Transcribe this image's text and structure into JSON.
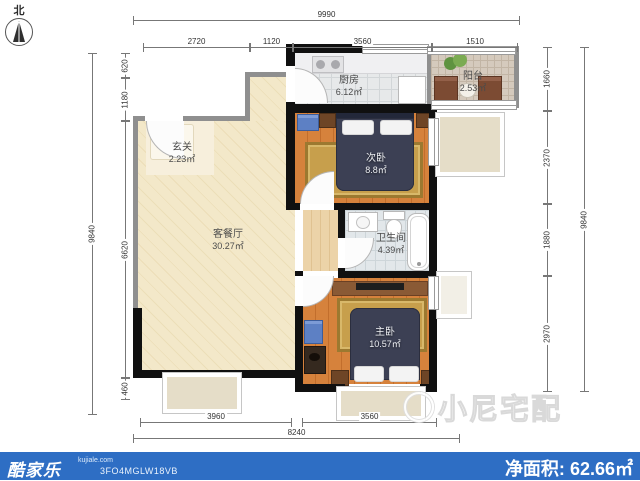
{
  "compass": {
    "north_label": "北"
  },
  "rooms": [
    {
      "id": "entry",
      "name": "玄关",
      "area": "2.23㎡"
    },
    {
      "id": "living",
      "name": "客餐厅",
      "area": "30.27㎡"
    },
    {
      "id": "kitchen",
      "name": "厨房",
      "area": "6.12㎡"
    },
    {
      "id": "balcony",
      "name": "阳台",
      "area": "2.53㎡"
    },
    {
      "id": "bedroom2",
      "name": "次卧",
      "area": "8.8㎡"
    },
    {
      "id": "bathroom",
      "name": "卫生间",
      "area": "4.39㎡"
    },
    {
      "id": "master",
      "name": "主卧",
      "area": "10.57㎡"
    }
  ],
  "dimensions": {
    "top": {
      "overall": "9990",
      "segments": [
        "2720",
        "1120",
        "3560",
        "1510"
      ]
    },
    "bottom": {
      "overall": "8240",
      "segments": [
        "3960",
        "3560"
      ]
    },
    "left": {
      "overall": "9840",
      "segments": [
        "620",
        "1180",
        "6620",
        "460"
      ]
    },
    "right": {
      "overall": "9840",
      "segments": [
        "1660",
        "2370",
        "1880",
        "2970"
      ]
    }
  },
  "watermark": {
    "text": "小尼宅配"
  },
  "footer": {
    "brand": "酷家乐",
    "site": "kujiale.com",
    "code": "3FO4MGLW18VB",
    "area_label": "净面积:",
    "area_value": "62.66㎡",
    "bar_color": "#2e6ec4"
  },
  "colors": {
    "wall_gray": "#8f8f8f",
    "wall_black": "#101010",
    "living_floor": "#f3e8c9",
    "wood_floor": "#d6823c",
    "rug_gold": "#c79f4c",
    "bed_navy": "#3c4054"
  }
}
